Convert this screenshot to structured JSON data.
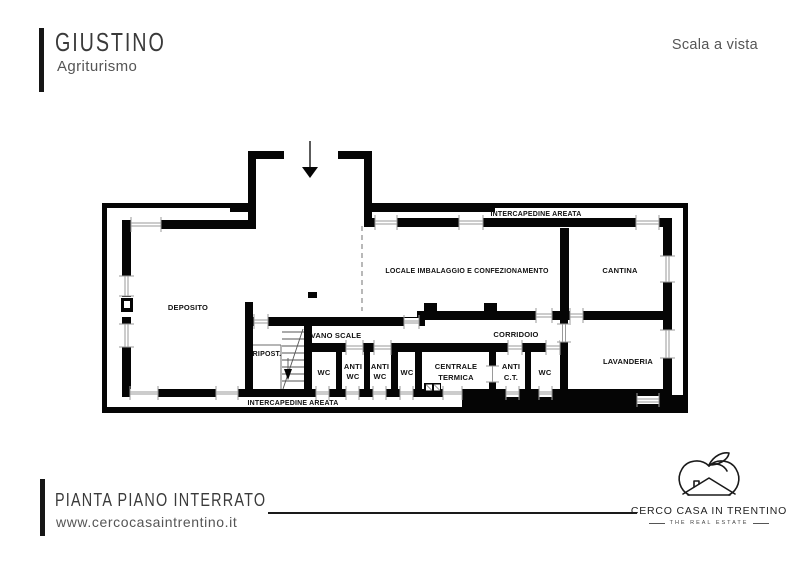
{
  "header": {
    "title": "GIUSTINO",
    "subtitle": "Agriturismo",
    "scale_note": "Scala a vista"
  },
  "plan": {
    "labels": {
      "intercapedine_top": "INTERCAPEDINE AREATA",
      "intercapedine_bottom": "INTERCAPEDINE AREATA",
      "deposito": "DEPOSITO",
      "locale_imballaggio": "LOCALE IMBALAGGIO E CONFEZIONAMENTO",
      "cantina": "CANTINA",
      "vano_scale": "VANO SCALE",
      "corridoio": "CORRIDOIO",
      "ripostiglio": "RIPOST.",
      "wc_1": "WC",
      "anti_wc_1": [
        "ANTI",
        "WC"
      ],
      "anti_wc_2": [
        "ANTI",
        "WC"
      ],
      "wc_2": "WC",
      "centrale_termica": [
        "CENTRALE",
        "TERMICA"
      ],
      "anti_ct": [
        "ANTI",
        "C.T."
      ],
      "wc_3": "WC",
      "lavanderia": "LAVANDERIA"
    }
  },
  "footer": {
    "plan_title": "PIANTA PIANO INTERRATO",
    "website": "www.cercocasaintrentino.it"
  },
  "brand": {
    "name": "CERCO CASA IN TRENTINO",
    "tagline": "THE REAL ESTATE"
  },
  "icons": {
    "entrance_arrow_icon": "down-arrow",
    "brand_logo_icon": "apple-house-outline"
  },
  "colors": {
    "wall": "#050505",
    "window_line": "#9a9a9a",
    "title_text": "#3a3a3a",
    "muted_text": "#555555",
    "rule_line": "#1a1a1a"
  }
}
